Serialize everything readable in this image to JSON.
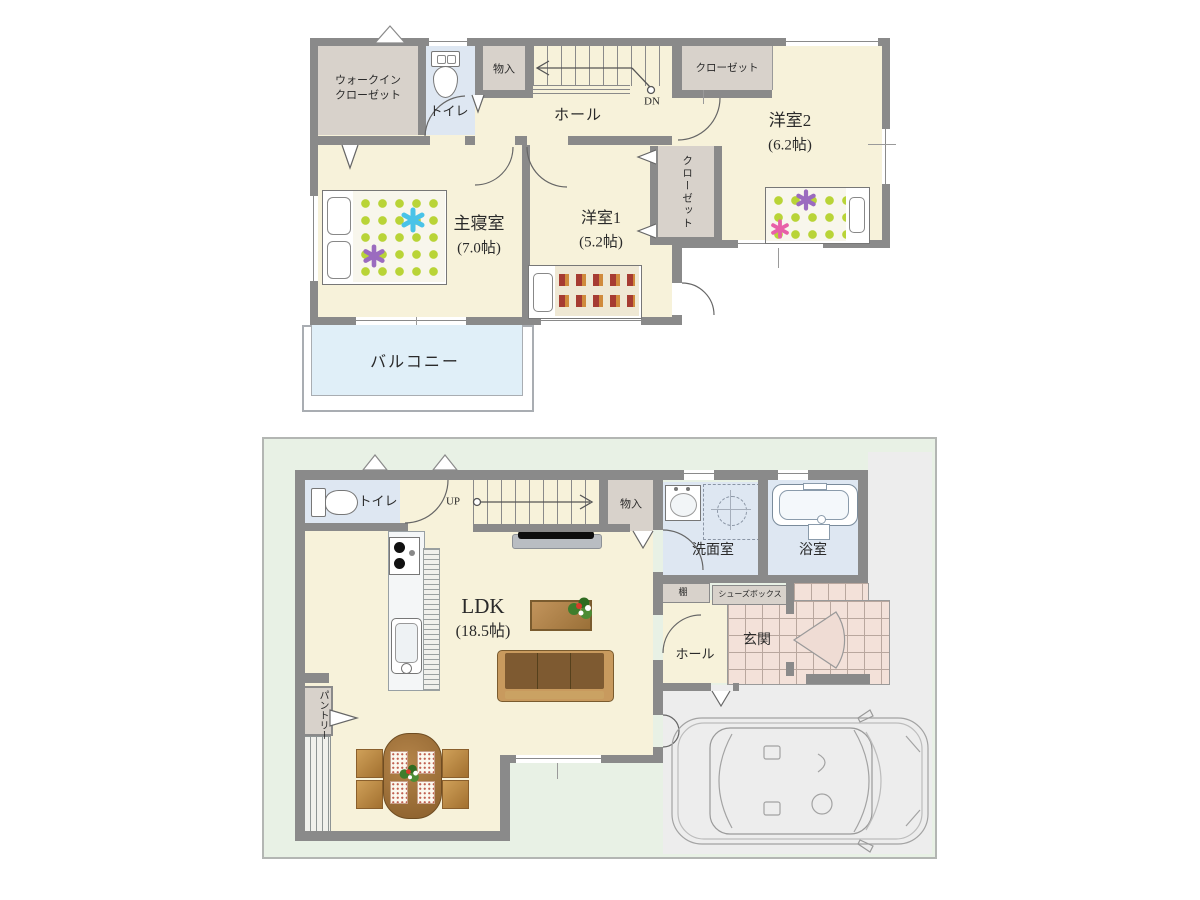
{
  "floor2": {
    "walk_in_closet": [
      "ウォークイン",
      "クローゼット"
    ],
    "toilet": "トイレ",
    "storage": "物入",
    "hall": "ホール",
    "stairs_down": "DN",
    "closet_top": "クローゼット",
    "bedroom2": "洋室2",
    "bedroom2_size": "(6.2帖)",
    "master_bedroom": "主寝室",
    "master_bedroom_size": "(7.0帖)",
    "bedroom1": "洋室1",
    "bedroom1_size": "(5.2帖)",
    "closet_side": "クローゼット",
    "balcony": "バルコニー"
  },
  "floor1": {
    "toilet": "トイレ",
    "stairs_up": "UP",
    "storage": "物入",
    "washroom": "洗面室",
    "bathroom": "浴室",
    "shelf": "棚",
    "shoe_box": "シューズボックス",
    "entrance": "玄関",
    "hall": "ホール",
    "ldk": "LDK",
    "ldk_size": "(18.5帖)",
    "pantry": "パントリー"
  },
  "colors": {
    "wall": "#8a8a8a",
    "floor_cream": "#f7f2da",
    "water_blue": "#dee7f2",
    "closet_beige": "#d8d2cb",
    "balcony_blue": "#e0eff8",
    "site_green": "#e8f1e5",
    "parking_gray": "#ededed",
    "tile_pink": "#f3e1d9",
    "mattress_dot_green": "#b9d437",
    "wood_brown": "#a9793f",
    "sofa_brown": "#7e5a31"
  }
}
